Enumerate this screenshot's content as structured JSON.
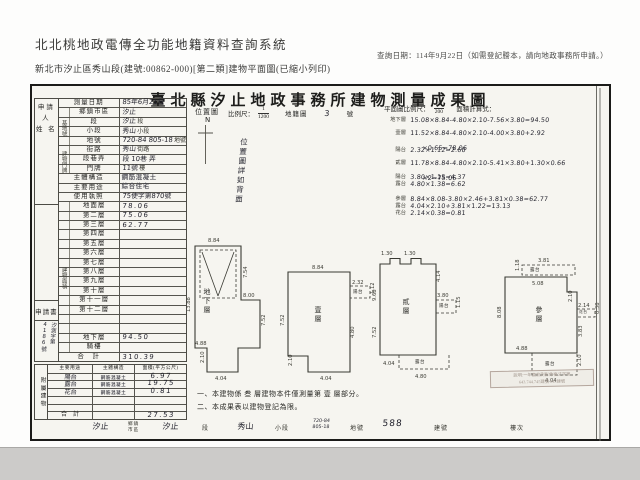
{
  "header": {
    "system_title": "北北桃地政電傳全功能地籍資料查詢系統",
    "query_date": "查詢日期：114年9月22日（如需登記謄本，請向地政事務所申請。）",
    "document_info": "新北市汐止區秀山段(建號:00862-000)[第二類]建物平面圖(已縮小列印)"
  },
  "form": {
    "title": "臺北縣汐止地政事務所建物測量成果圖",
    "applicant_label": "申請人\n姓 名",
    "application": {
      "label": "申請書",
      "number": "汐測字第4186號"
    },
    "survey_date": {
      "label": "測量日期",
      "value": "85年6月21日"
    },
    "site_group_label": "基地號",
    "addr_group_label": "建物門牌",
    "floor_group_label": "建物面積",
    "site": {
      "town": {
        "label": "鄉鎮市區",
        "value": "汐止"
      },
      "section": {
        "label": "段",
        "value": "汐止",
        "suffix": "段"
      },
      "subsection": {
        "label": "小段",
        "value": "秀山",
        "suffix": "小段"
      },
      "lot": {
        "label": "地號",
        "value": "720-84 805-18",
        "suffix": "地號"
      }
    },
    "address": {
      "street": {
        "label": "街路",
        "value": "秀山",
        "suffix": "街路"
      },
      "lane": {
        "label": "段巷弄",
        "value": "段 10巷 弄"
      },
      "number": {
        "label": "門牌",
        "value": "11號",
        "suffix": "樓"
      }
    },
    "structure": {
      "label": "主體構造",
      "value": "鋼筋混凝土"
    },
    "usage": {
      "label": "主要用途",
      "value": "綜合住宅"
    },
    "license": {
      "label": "使用執照",
      "value": "75使字第870號"
    },
    "floor_area": {
      "rows": [
        {
          "label": "地面層",
          "value": "78.06"
        },
        {
          "label": "第二層",
          "value": "75.06"
        },
        {
          "label": "第三層",
          "value": "62.77"
        },
        {
          "label": "第四層",
          "value": ""
        },
        {
          "label": "第五層",
          "value": ""
        },
        {
          "label": "第六層",
          "value": ""
        },
        {
          "label": "第七層",
          "value": ""
        },
        {
          "label": "第八層",
          "value": ""
        },
        {
          "label": "第九層",
          "value": ""
        },
        {
          "label": "第十層",
          "value": ""
        },
        {
          "label": "第十一層",
          "value": ""
        },
        {
          "label": "第十二層",
          "value": ""
        },
        {
          "label": "",
          "value": ""
        },
        {
          "label": "",
          "value": ""
        },
        {
          "label": "地下層",
          "value": "94.50"
        },
        {
          "label": "騎樓",
          "value": ""
        }
      ],
      "total_label": "合　計",
      "total": "310.39"
    },
    "annex": {
      "group_label": "附屬建物",
      "headers": [
        "主要用途",
        "主體構造",
        "面積(平方公尺)"
      ],
      "rows": [
        {
          "use": "陽台",
          "structure": "鋼筋混凝土",
          "area": "6.97"
        },
        {
          "use": "露台",
          "structure": "鋼筋混凝土",
          "area": "19.75"
        },
        {
          "use": "花台",
          "structure": "鋼筋混凝土",
          "area": "0.81"
        },
        {
          "use": "",
          "structure": "",
          "area": ""
        },
        {
          "use": "",
          "structure": "",
          "area": ""
        }
      ],
      "total_label": "合　計",
      "total": "27.53"
    },
    "location_map": {
      "label": "位置圖",
      "north": "N",
      "scale_label": "比例尺：",
      "scale_num": "1",
      "scale_den": "1200",
      "map_label": "地籍圖",
      "sheet_no": "3",
      "sheet_suffix": "號",
      "back_note": "位置圖詳如背面"
    },
    "plan_header": {
      "scale_label": "平面圖比例尺：",
      "scale_num": "1",
      "scale_den": "200",
      "calc_label": "面積計算式："
    },
    "calculations": [
      {
        "label": "地下層",
        "expr": "15.08×8.84-4.80×2.10-7.56×3.80=94.50"
      },
      {
        "label": "壹層",
        "expr": "11.52×8.84-4.80×2.10-4.00×3.80+2.92",
        "expr2": "×0.65=78.06"
      },
      {
        "label": "陽台",
        "expr": "2.32×1.12=2.60"
      },
      {
        "label": "貳層",
        "expr": "11.78×8.84-4.80×2.10-5.41×3.80+1.30×0.66",
        "expr2": "×2=75.06"
      },
      {
        "label": "陽台",
        "expr": "3.80×1.15=4.37"
      },
      {
        "label": "露台",
        "expr": "4.80×1.38=6.62"
      },
      {
        "label": "參層",
        "expr": "8.84×8.08-3.80×2.46+3.81×0.38=62.77"
      },
      {
        "label": "露台",
        "expr": "4.04×2.10+3.81×1.22=13.13"
      },
      {
        "label": "花台",
        "expr": "2.14×0.38=0.81"
      }
    ],
    "plans": [
      {
        "name": "地下層",
        "dims": [
          "8.84",
          "13.88",
          "7.54",
          "8.00",
          "7.52",
          "4.88",
          "2.10",
          "4.04"
        ]
      },
      {
        "name": "壹層",
        "tags": [
          "陽台"
        ],
        "dims": [
          "8.84",
          "2.32",
          "1.12",
          "7.52",
          "2.10",
          "4.04",
          "4.80"
        ]
      },
      {
        "name": "貳層",
        "tags": [
          "陽台",
          "露台"
        ],
        "dims": [
          "1.30",
          "1.30",
          "9.68",
          "4.14",
          "3.80",
          "1.15",
          "7.52",
          "4.80",
          "4.04"
        ]
      },
      {
        "name": "參層",
        "tags": [
          "露台",
          "花台",
          "露台"
        ],
        "dims": [
          "3.81",
          "1.18",
          "5.08",
          "8.08",
          "2.14",
          "0.38",
          "2.10",
          "3.83",
          "4.88",
          "4.04",
          "2.10"
        ]
      }
    ],
    "notes": [
      "一、本建物係 叁 層建物本件僅測量第 壹 層部分。",
      "二、本成果表以建物登記為限。"
    ],
    "stamp": {
      "line1": "說明:一年度航測影像複丈字第",
      "line2": "643.744.745建號 843建號"
    },
    "footer_strip": {
      "town_value": "汐止",
      "town_label": "鄉鎮\n市區",
      "sec_value": "汐止",
      "sec_label": "段",
      "subsec_value": "秀山",
      "subsec_label": "小段",
      "lot_values": "720-84\n805-18",
      "lot_label": "地號",
      "bldg_value": "588",
      "bldg_label": "建號",
      "floor_label": "樓次"
    }
  }
}
